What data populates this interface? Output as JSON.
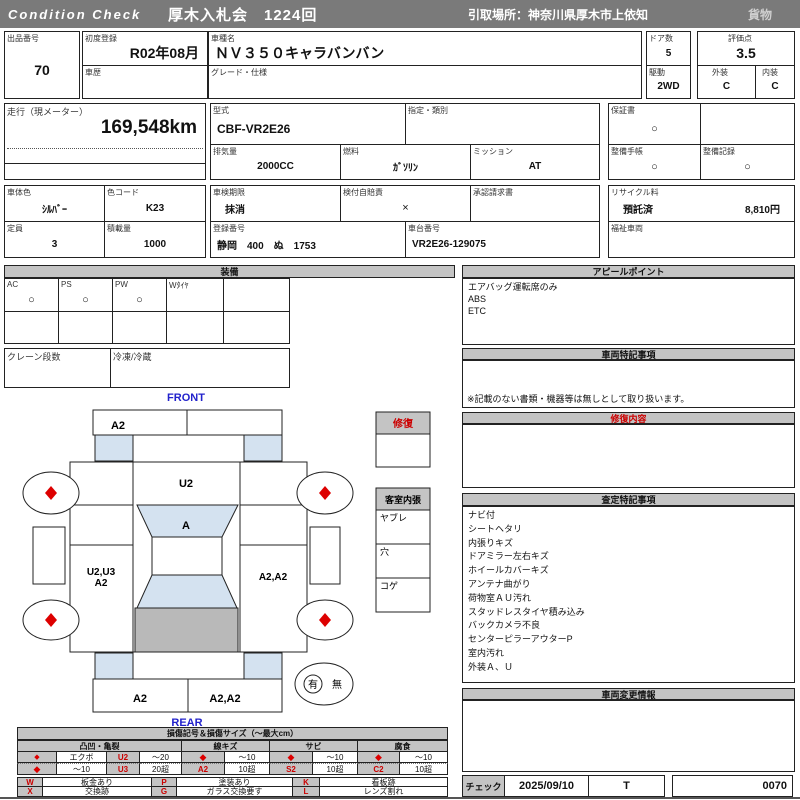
{
  "header": {
    "brand": "Condition  Check",
    "auction": "厚木入札会　1224回",
    "pickup": "引取場所：神奈川県厚木市上依知",
    "category": "貨物"
  },
  "info": {
    "lot_label": "出品番号",
    "lot_value": "70",
    "first_reg_label": "初度登録",
    "first_reg_value": "R02年08月",
    "history_label": "車歴",
    "history_value": "",
    "model_name_label": "車種名",
    "model_name_value": "ＮＶ３５０キャラバンバン",
    "grade_label": "グレード・仕様",
    "grade_value": "",
    "doors_label": "ドア数",
    "doors_value": "5",
    "drive_label": "駆動",
    "drive_value": "2WD",
    "score_label": "評価点",
    "score_value": "3.5",
    "exterior_label": "外装",
    "exterior_value": "C",
    "interior_label": "内装",
    "interior_value": "C",
    "mileage_label": "走行（現メーター）",
    "mileage_value": "169,548km",
    "model_code_label": "型式",
    "model_code_value": "CBF-VR2E26",
    "class_label": "指定・類別",
    "class_value": "",
    "displacement_label": "排気量",
    "displacement_value": "2000CC",
    "fuel_label": "燃料",
    "fuel_value": "ｶﾞｿﾘﾝ",
    "transmission_label": "ミッション",
    "transmission_value": "AT",
    "warranty_label": "保証書",
    "warranty_value": "○",
    "maintenance_book_label": "整備手帳",
    "maintenance_book_value": "○",
    "maintenance_record_label": "整備記録",
    "maintenance_record_value": "○",
    "body_color_label": "車体色",
    "body_color_value": "ｼﾙﾊﾞｰ",
    "color_code_label": "色コード",
    "color_code_value": "K23",
    "capacity_label": "定員",
    "capacity_value": "3",
    "load_label": "積載量",
    "load_value": "1000",
    "inspection_label": "車検期限",
    "inspection_value": "抹消",
    "insurance_label": "検付自賠責",
    "insurance_value": "×",
    "approval_label": "承認請求書",
    "approval_value": "",
    "reg_number_label": "登録番号",
    "reg_number_value": "静岡　400　ぬ　1753",
    "chassis_label": "車台番号",
    "chassis_value": "VR2E26-129075",
    "recycle_label": "リサイクル料",
    "recycle_status": "預託済",
    "recycle_fee": "8,810円",
    "welfare_label": "福祉車両",
    "welfare_value": ""
  },
  "equipment": {
    "title": "装備",
    "items": [
      {
        "label": "AC",
        "value": "○"
      },
      {
        "label": "PS",
        "value": "○"
      },
      {
        "label": "PW",
        "value": "○"
      },
      {
        "label": "Wﾀｲﾔ",
        "value": ""
      },
      {
        "label": "",
        "value": ""
      }
    ],
    "crane_label": "クレーン段数",
    "crane_value": "",
    "reefer_label": "冷凍/冷蔵",
    "reefer_value": ""
  },
  "appeal": {
    "title": "アピールポイント",
    "items": [
      "エアバッグ運転席のみ",
      "ABS",
      "ETC"
    ]
  },
  "vehicle_notes": {
    "title": "車両特記事項",
    "note": "※記載のない書類・機器等は無しとして取り扱います。"
  },
  "repair": {
    "title": "修復内容",
    "content": ""
  },
  "assessment": {
    "title": "査定特記事項",
    "items": [
      "ナビ付",
      "シートヘタリ",
      "内張りキズ",
      "ドアミラー左右キズ",
      "ホイールカバーキズ",
      "アンテナ曲がり",
      "荷物室ＡＵ汚れ",
      "スタッドレスタイヤ積み込み",
      "バックカメラ不良",
      "センターピラーアウターP",
      "室内汚れ",
      "外装Ａ、Ｕ"
    ]
  },
  "change_info": {
    "title": "車両変更情報",
    "content": ""
  },
  "check": {
    "label": "チェック",
    "date": "2025/09/10",
    "inspector": "T",
    "number": "0070"
  },
  "diagram": {
    "front_label": "FRONT",
    "rear_label": "REAR",
    "repair_box_title": "修復",
    "interior_box_title": "客室内張",
    "interior_row_1": "ヤブレ",
    "interior_row_2": "穴",
    "interior_row_3": "コゲ",
    "spare_yes": "有",
    "spare_no": "無",
    "zones": {
      "front_bumper_left": "A2",
      "hood": "U2",
      "windshield": "A",
      "left_side_1": "U2,U3",
      "left_side_2": "A2",
      "right_side": "A2,A2",
      "rear_bumper_left": "A2",
      "rear_bumper_right": "A2,A2"
    }
  },
  "legend": {
    "title": "損傷記号＆損傷サイズ（〜最大cm）",
    "groups": [
      "凸凹・亀裂",
      "線キズ",
      "サビ",
      "腐食"
    ],
    "rows": [
      {
        "cells": [
          "◆",
          "エクボ",
          "U2",
          "〜20",
          "◆",
          "〜10",
          "◆",
          "〜10",
          "◆",
          "〜10"
        ]
      },
      {
        "cells": [
          "◆",
          "〜10",
          "U3",
          "20超",
          "A2",
          "10超",
          "S2",
          "10超",
          "C2",
          "10超"
        ]
      }
    ],
    "codes": [
      {
        "code": "W",
        "desc": "板金あり"
      },
      {
        "code": "P",
        "desc": "塗装あり"
      },
      {
        "code": "K",
        "desc": "看板跡"
      },
      {
        "code": "X",
        "desc": "交換跡"
      },
      {
        "code": "G",
        "desc": "ガラス交換要す"
      },
      {
        "code": "L",
        "desc": "レンズ割れ"
      }
    ]
  },
  "colors": {
    "header_bg": "#7a7a7a",
    "section_bg": "#c4c4c4",
    "accent_red": "#dd0000",
    "diagram_blue": "#2222cc",
    "glass_blue": "#d4e2f0",
    "cargo_gray": "#b9b9b9"
  }
}
